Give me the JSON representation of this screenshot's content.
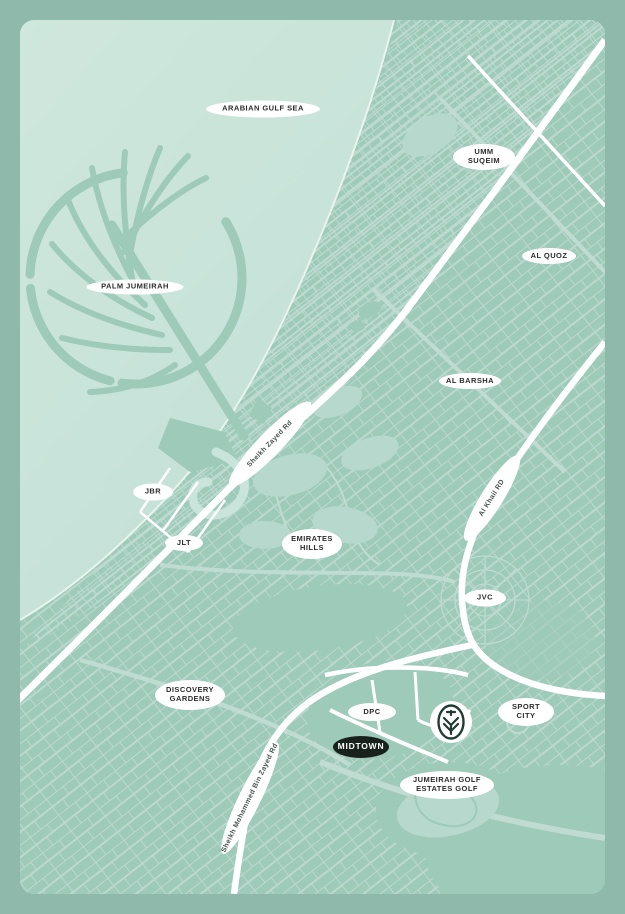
{
  "map": {
    "name": "Dubai location map",
    "colors": {
      "frame": "#8fb9ab",
      "sea": "#c9e4da",
      "land": "#9ecaba",
      "street_lines": "#bedbd1",
      "golf_green": "#b7d8cc",
      "road_white": "#ffffff",
      "pill_background": "#ffffff",
      "pill_text": "#2d2d2d",
      "badge_background": "#19211c",
      "badge_text": "#ffffff",
      "lake_blue": "#b5dce7",
      "logo_dark": "#223c33"
    },
    "labels": [
      {
        "id": "arabian-gulf-sea",
        "lines": [
          "ARABIAN GULF SEA"
        ]
      },
      {
        "id": "umm-suqeim",
        "lines": [
          "UMM",
          "SUQEIM"
        ]
      },
      {
        "id": "al-quoz",
        "lines": [
          "AL QUOZ"
        ]
      },
      {
        "id": "palm-jumeirah",
        "lines": [
          "PALM JUMEIRAH"
        ]
      },
      {
        "id": "al-barsha",
        "lines": [
          "AL BARSHA"
        ]
      },
      {
        "id": "jbr",
        "lines": [
          "JBR"
        ]
      },
      {
        "id": "jlt",
        "lines": [
          "JLT"
        ]
      },
      {
        "id": "emirates-hills",
        "lines": [
          "EMIRATES",
          "HILLS"
        ]
      },
      {
        "id": "jvc",
        "lines": [
          "JVC"
        ]
      },
      {
        "id": "discovery-gardens",
        "lines": [
          "DISCOVERY",
          "GARDENS"
        ]
      },
      {
        "id": "dpc",
        "lines": [
          "DPC"
        ]
      },
      {
        "id": "sport-city",
        "lines": [
          "SPORT",
          "CITY"
        ]
      },
      {
        "id": "jumeirah-golf-estates",
        "lines": [
          "JUMEIRAH GOLF",
          "ESTATES GOLF"
        ]
      },
      {
        "id": "midtown",
        "lines": [
          "MIDTOWN"
        ]
      }
    ],
    "road_labels": [
      {
        "id": "sheikh-zayed-rd",
        "text": "Sheikh Zayed Rd"
      },
      {
        "id": "al-khail-rd",
        "text": "Al Khail RD"
      },
      {
        "id": "sheikh-mohammed-bin-zayed-rd",
        "text": "Sheikh Mohammed Bin Zayed Rd"
      }
    ],
    "landmark_logo": {
      "name": "midtown-development-logo"
    }
  }
}
